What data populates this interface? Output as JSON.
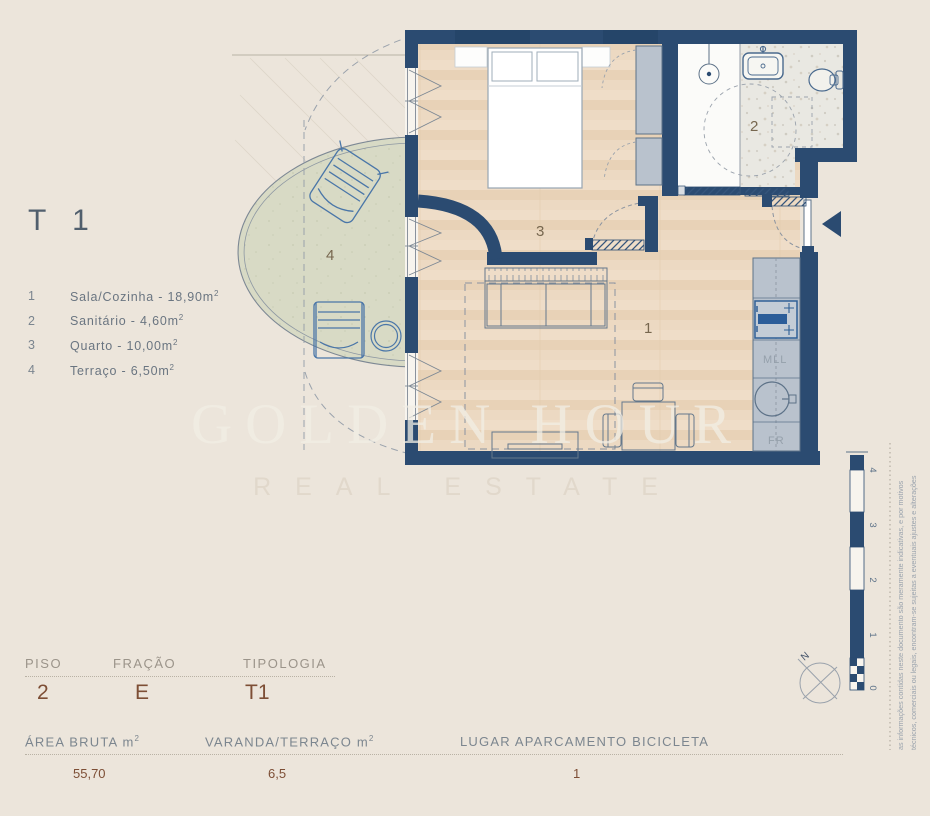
{
  "legend": {
    "title": "T 1",
    "items": [
      {
        "num": "1",
        "text": "Sala/Cozinha - 18,90m",
        "sup": "2"
      },
      {
        "num": "2",
        "text": "Sanitário - 4,60m",
        "sup": "2"
      },
      {
        "num": "3",
        "text": "Quarto - 10,00m",
        "sup": "2"
      },
      {
        "num": "4",
        "text": "Terraço - 6,50m",
        "sup": "2"
      }
    ]
  },
  "plan": {
    "rooms": {
      "living": "1",
      "bath": "2",
      "bedroom": "3",
      "terrace": "4"
    },
    "kitchen": {
      "dishwasher_label": "MLL",
      "fridge_label": "FR"
    },
    "compass_north": "N"
  },
  "watermark": {
    "line1": "GOLDEN HOUR",
    "line2": "REAL ESTATE"
  },
  "scalebar": {
    "tick4": "4",
    "tick3": "3",
    "tick2": "2",
    "tick1": "1",
    "tick0": "0"
  },
  "disclaimer": {
    "line1": "as informações contidas neste documento são meramente indicativas, e por motivos",
    "line2": "técnicos, comerciais ou legais, encontram-se sujeitas a eventuais ajustes e alterações"
  },
  "info": {
    "piso_label": "PISO",
    "piso_value": "2",
    "fracao_label": "FRAÇÃO",
    "fracao_value": "E",
    "tipologia_label": "TIPOLOGIA",
    "tipologia_value": "T1",
    "area_bruta_label": "ÁREA BRUTA m",
    "area_bruta_sup": "2",
    "area_bruta_value": "55,70",
    "varanda_label": "VARANDA/TERRAÇO m",
    "varanda_sup": "2",
    "varanda_value": "6,5",
    "lugar_label": "LUGAR APARCAMENTO BICICLETA",
    "lugar_value": "1"
  },
  "colors": {
    "wall": "#2b4b71",
    "furniture_blue": "#4a76a8",
    "value_brown": "#7d4e35",
    "floor_wood": "#ecd9c1",
    "terrace_floor": "#d8dac5"
  }
}
